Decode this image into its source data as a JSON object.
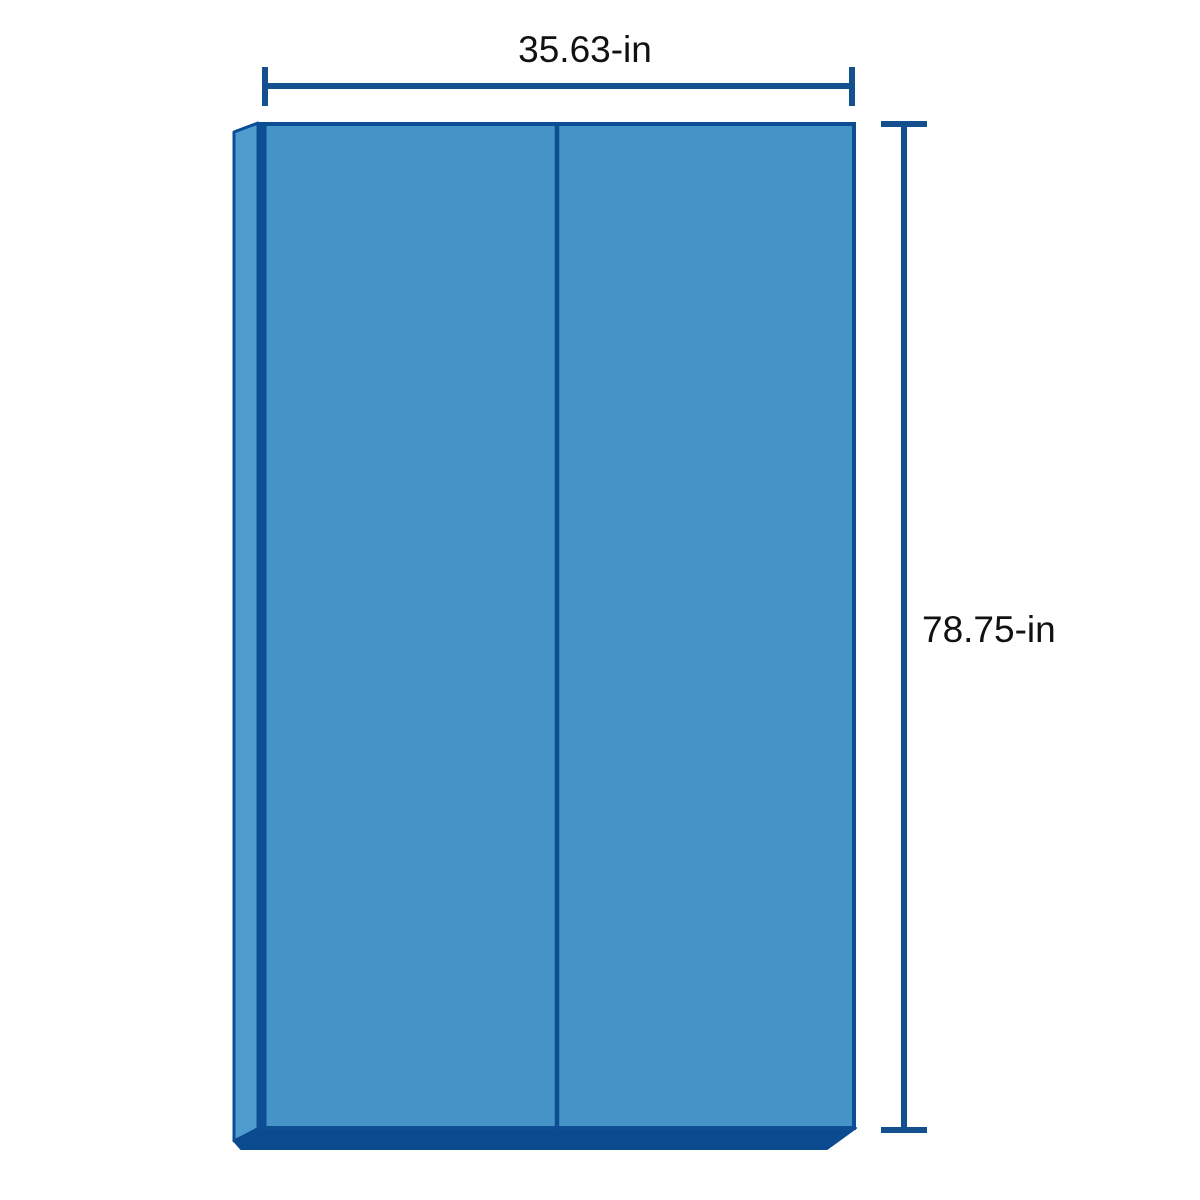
{
  "diagram": {
    "type": "product-dimension-illustration",
    "object": "two-fold rectangular panel shown in light 3D perspective",
    "width": {
      "label": "35.63-in",
      "value_in": 35.63
    },
    "height": {
      "label": "78.75-in",
      "value_in": 78.75
    }
  },
  "colors": {
    "background": "#ffffff",
    "face": "#4594c8",
    "side_edge": "#4f9bce",
    "bottom_edge": "#0a4a8e",
    "outline": "#0d4d94",
    "dimension_line": "#15508e",
    "label_text": "#111111"
  }
}
